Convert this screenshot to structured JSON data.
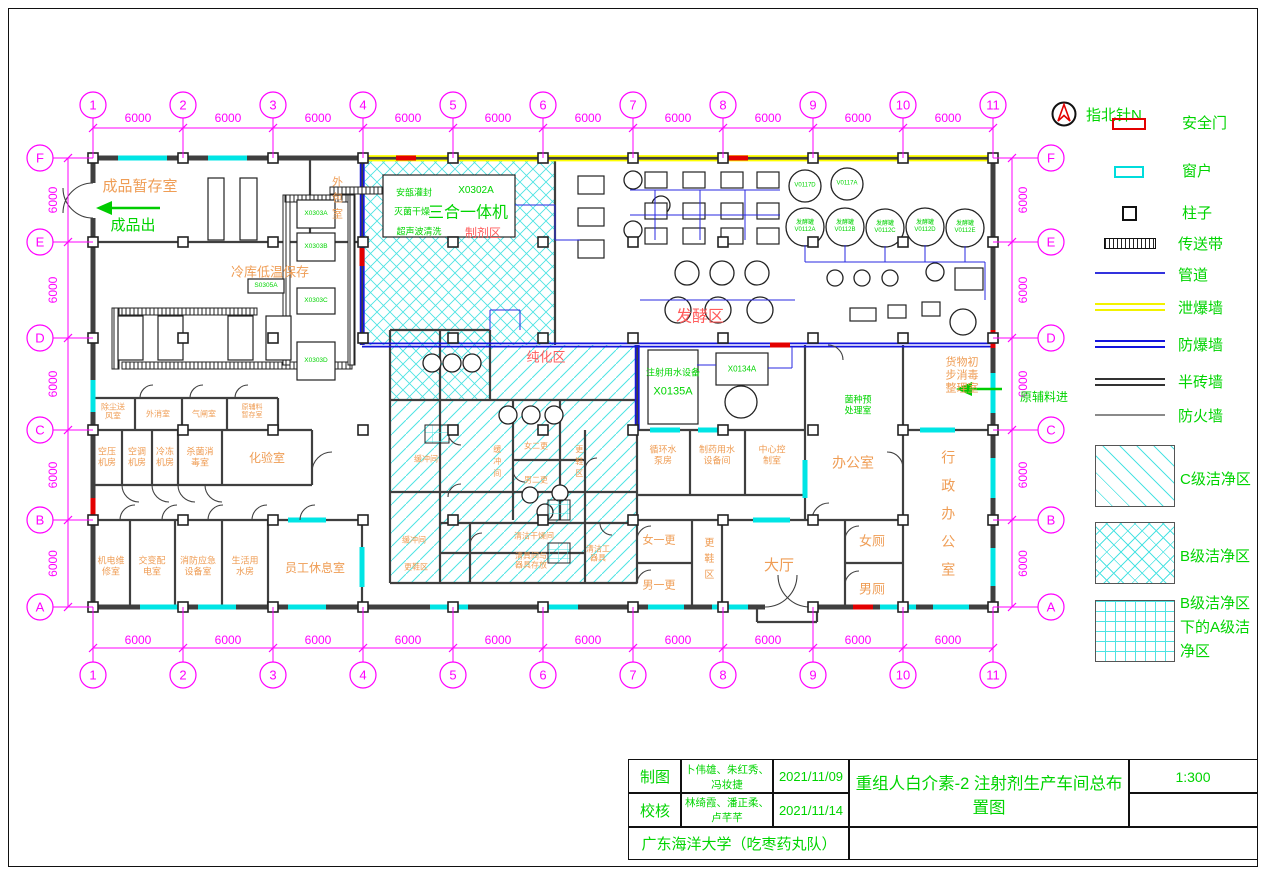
{
  "drawing": {
    "compass_label": "指北针N",
    "scale": "1:300",
    "grid": {
      "dim_label": "6000",
      "columns": [
        {
          "n": "1",
          "x": 93
        },
        {
          "n": "2",
          "x": 183
        },
        {
          "n": "3",
          "x": 273
        },
        {
          "n": "4",
          "x": 363
        },
        {
          "n": "5",
          "x": 453
        },
        {
          "n": "6",
          "x": 543
        },
        {
          "n": "7",
          "x": 633
        },
        {
          "n": "8",
          "x": 723
        },
        {
          "n": "9",
          "x": 813
        },
        {
          "n": "10",
          "x": 903
        },
        {
          "n": "11",
          "x": 993
        }
      ],
      "rows": [
        {
          "n": "F",
          "y": 158
        },
        {
          "n": "E",
          "y": 242
        },
        {
          "n": "D",
          "y": 338
        },
        {
          "n": "C",
          "y": 430
        },
        {
          "n": "B",
          "y": 520
        },
        {
          "n": "A",
          "y": 607
        }
      ]
    }
  },
  "legend": {
    "items": [
      {
        "key": "safety-door",
        "label": "安全门"
      },
      {
        "key": "window",
        "label": "窗户"
      },
      {
        "key": "column",
        "label": "柱子"
      },
      {
        "key": "conveyor",
        "label": "传送带"
      },
      {
        "key": "pipe",
        "label": "管道"
      },
      {
        "key": "vent-wall",
        "label": "泄爆墙"
      },
      {
        "key": "blast-wall",
        "label": "防爆墙"
      },
      {
        "key": "half-brick-wall",
        "label": "半砖墙"
      },
      {
        "key": "fire-wall",
        "label": "防火墙"
      }
    ],
    "zones": [
      {
        "key": "clean-c",
        "label": "C级洁净区"
      },
      {
        "key": "clean-b",
        "label": "B级洁净区"
      },
      {
        "key": "clean-a",
        "label": "B级洁净区\n下的A级洁\n净区"
      }
    ]
  },
  "titleblock": {
    "drawn_label": "制图",
    "drawn_by": "卜伟雄、朱红秀、冯妆捷",
    "drawn_date": "2021/11/09",
    "checked_label": "校核",
    "checked_by": "林绮霞、潘正柔、卢芊芊",
    "checked_date": "2021/11/14",
    "org": "广东海洋大学（吃枣药丸队）",
    "title": "重组人白介素-2 注射剂生产车间总布置图",
    "scale": "1:300"
  },
  "labels": [
    {
      "t": "成品暂存室",
      "x": 140,
      "y": 187,
      "s": 15,
      "c": "or"
    },
    {
      "t": "成品出",
      "x": 133,
      "y": 226,
      "s": 15,
      "c": "grn"
    },
    {
      "t": "外包室",
      "x": 336,
      "y": 200,
      "s": 11,
      "c": "or",
      "v": 1,
      "ls": 5
    },
    {
      "t": "冷库低温保存",
      "x": 270,
      "y": 272,
      "s": 13,
      "c": "or"
    },
    {
      "t": "除尘送\n风室",
      "x": 113,
      "y": 412,
      "s": 8,
      "c": "or"
    },
    {
      "t": "外消室",
      "x": 158,
      "y": 414,
      "s": 8,
      "c": "or"
    },
    {
      "t": "气闸室",
      "x": 204,
      "y": 414,
      "s": 8,
      "c": "or"
    },
    {
      "t": "原辅料\n暂存室",
      "x": 252,
      "y": 412,
      "s": 7,
      "c": "or"
    },
    {
      "t": "空压\n机房",
      "x": 107,
      "y": 457,
      "s": 9,
      "c": "or"
    },
    {
      "t": "空调\n机房",
      "x": 137,
      "y": 457,
      "s": 9,
      "c": "or"
    },
    {
      "t": "冷冻\n机房",
      "x": 165,
      "y": 457,
      "s": 9,
      "c": "or"
    },
    {
      "t": "杀菌消\n毒室",
      "x": 200,
      "y": 457,
      "s": 9,
      "c": "or"
    },
    {
      "t": "化验室",
      "x": 267,
      "y": 458,
      "s": 12,
      "c": "or"
    },
    {
      "t": "机电维\n修室",
      "x": 111,
      "y": 566,
      "s": 9,
      "c": "or"
    },
    {
      "t": "交变配\n电室",
      "x": 152,
      "y": 566,
      "s": 9,
      "c": "or"
    },
    {
      "t": "消防应急\n设备室",
      "x": 198,
      "y": 566,
      "s": 9,
      "c": "or"
    },
    {
      "t": "生活用\n水房",
      "x": 245,
      "y": 566,
      "s": 9,
      "c": "or"
    },
    {
      "t": "员工休息室",
      "x": 315,
      "y": 568,
      "s": 12,
      "c": "or"
    },
    {
      "t": "缓冲间",
      "x": 426,
      "y": 459,
      "s": 8,
      "c": "or"
    },
    {
      "t": "缓冲间",
      "x": 497,
      "y": 463,
      "s": 8,
      "c": "or",
      "v": 1
    },
    {
      "t": "女二更",
      "x": 536,
      "y": 446,
      "s": 8,
      "c": "or"
    },
    {
      "t": "男二更",
      "x": 536,
      "y": 480,
      "s": 8,
      "c": "or"
    },
    {
      "t": "更鞋区",
      "x": 579,
      "y": 463,
      "s": 8,
      "c": "or",
      "v": 1
    },
    {
      "t": "缓冲间",
      "x": 414,
      "y": 540,
      "s": 8,
      "c": "or"
    },
    {
      "t": "更鞋区",
      "x": 416,
      "y": 567,
      "s": 8,
      "c": "or"
    },
    {
      "t": "清洁干燥间",
      "x": 534,
      "y": 536,
      "s": 8,
      "c": "or"
    },
    {
      "t": "清具间与\n器具存放",
      "x": 531,
      "y": 561,
      "s": 8,
      "c": "or"
    },
    {
      "t": "清洁工\n器具",
      "x": 598,
      "y": 554,
      "s": 8,
      "c": "or"
    },
    {
      "t": "更鞋区",
      "x": 707,
      "y": 561,
      "s": 10,
      "c": "or",
      "v": 1,
      "ls": 6
    },
    {
      "t": "女一更",
      "x": 659,
      "y": 541,
      "s": 11,
      "c": "or"
    },
    {
      "t": "男一更",
      "x": 659,
      "y": 586,
      "s": 11,
      "c": "or"
    },
    {
      "t": "大厅",
      "x": 779,
      "y": 566,
      "s": 15,
      "c": "or"
    },
    {
      "t": "女厕",
      "x": 872,
      "y": 541,
      "s": 13,
      "c": "or"
    },
    {
      "t": "男厕",
      "x": 872,
      "y": 589,
      "s": 13,
      "c": "or"
    },
    {
      "t": "循环水\n泵房",
      "x": 663,
      "y": 455,
      "s": 9,
      "c": "or"
    },
    {
      "t": "制药用水\n设备间",
      "x": 717,
      "y": 455,
      "s": 9,
      "c": "or"
    },
    {
      "t": "中心控\n制室",
      "x": 772,
      "y": 455,
      "s": 9,
      "c": "or"
    },
    {
      "t": "办公室",
      "x": 853,
      "y": 463,
      "s": 14,
      "c": "or"
    },
    {
      "t": "行政办公室",
      "x": 948,
      "y": 520,
      "s": 14,
      "c": "or",
      "v": 1,
      "ls": 14
    },
    {
      "t": "货物初\n步消毒\n整理室",
      "x": 962,
      "y": 376,
      "s": 11,
      "c": "or"
    },
    {
      "t": "制剂区",
      "x": 483,
      "y": 233,
      "s": 12,
      "c": "pk"
    },
    {
      "t": "发酵区",
      "x": 700,
      "y": 318,
      "s": 16,
      "c": "pk"
    },
    {
      "t": "纯化区",
      "x": 546,
      "y": 357,
      "s": 13,
      "c": "pk"
    },
    {
      "t": "菌种预\n处理室",
      "x": 858,
      "y": 405,
      "s": 9,
      "c": "grn"
    },
    {
      "t": "注射用水设备",
      "x": 673,
      "y": 373,
      "s": 9,
      "c": "grn"
    },
    {
      "t": "X0135A",
      "x": 673,
      "y": 392,
      "s": 11,
      "c": "grn"
    },
    {
      "t": "X0134A",
      "x": 742,
      "y": 369,
      "s": 8,
      "c": "grn"
    },
    {
      "t": "安瓿灌封",
      "x": 414,
      "y": 193,
      "s": 9,
      "c": "grn"
    },
    {
      "t": "X0302A",
      "x": 476,
      "y": 191,
      "s": 10,
      "c": "grn"
    },
    {
      "t": "灭菌干燥",
      "x": 412,
      "y": 212,
      "s": 9,
      "c": "grn"
    },
    {
      "t": "三合一体机",
      "x": 468,
      "y": 214,
      "s": 16,
      "c": "grn"
    },
    {
      "t": "超声波清洗",
      "x": 419,
      "y": 232,
      "s": 9,
      "c": "grn"
    },
    {
      "t": "原辅料进",
      "x": 1044,
      "y": 397,
      "s": 12,
      "c": "grn"
    },
    {
      "t": "V0117D",
      "x": 805,
      "y": 186,
      "s": 6,
      "c": "grn"
    },
    {
      "t": "V0117A",
      "x": 847,
      "y": 184,
      "s": 6,
      "c": "grn"
    },
    {
      "t": "发酵罐\nV0112A",
      "x": 805,
      "y": 227,
      "s": 6,
      "c": "grn"
    },
    {
      "t": "发酵罐\nV0112B",
      "x": 845,
      "y": 227,
      "s": 6,
      "c": "grn"
    },
    {
      "t": "发酵罐\nV0112C",
      "x": 885,
      "y": 228,
      "s": 6,
      "c": "grn"
    },
    {
      "t": "发酵罐\nV0112D",
      "x": 925,
      "y": 227,
      "s": 6,
      "c": "grn"
    },
    {
      "t": "发酵罐\nV0112E",
      "x": 965,
      "y": 228,
      "s": 6,
      "c": "grn"
    },
    {
      "t": "X0303A",
      "x": 316,
      "y": 214,
      "s": 6.5,
      "c": "grn"
    },
    {
      "t": "X0303B",
      "x": 316,
      "y": 247,
      "s": 6.5,
      "c": "grn"
    },
    {
      "t": "X0303C",
      "x": 316,
      "y": 301,
      "s": 6.5,
      "c": "grn"
    },
    {
      "t": "X0303D",
      "x": 316,
      "y": 361,
      "s": 6.5,
      "c": "grn"
    },
    {
      "t": "S0305A",
      "x": 266,
      "y": 286,
      "s": 6.5,
      "c": "grn"
    }
  ],
  "equipment": {
    "circles": [
      [
        805,
        227,
        19
      ],
      [
        845,
        227,
        19
      ],
      [
        885,
        228,
        19
      ],
      [
        925,
        227,
        19
      ],
      [
        965,
        228,
        19
      ],
      [
        805,
        186,
        16
      ],
      [
        847,
        184,
        16
      ],
      [
        687,
        273,
        12
      ],
      [
        722,
        273,
        12
      ],
      [
        757,
        273,
        12
      ],
      [
        678,
        310,
        13
      ],
      [
        718,
        310,
        13
      ],
      [
        760,
        310,
        13
      ],
      [
        835,
        278,
        8
      ],
      [
        862,
        278,
        8
      ],
      [
        890,
        278,
        8
      ],
      [
        935,
        272,
        9
      ],
      [
        963,
        322,
        13
      ],
      [
        633,
        180,
        9
      ],
      [
        661,
        205,
        9
      ],
      [
        633,
        230,
        9
      ],
      [
        432,
        363,
        9
      ],
      [
        452,
        363,
        9
      ],
      [
        472,
        363,
        9
      ],
      [
        508,
        415,
        9
      ],
      [
        531,
        415,
        9
      ],
      [
        554,
        415,
        9
      ],
      [
        741,
        402,
        16
      ],
      [
        530,
        495,
        8
      ],
      [
        560,
        493,
        8
      ],
      [
        545,
        512,
        8
      ]
    ],
    "rects": [
      [
        383,
        175,
        132,
        62
      ],
      [
        208,
        178,
        16,
        62
      ],
      [
        240,
        178,
        17,
        62
      ],
      [
        648,
        350,
        50,
        74
      ],
      [
        716,
        353,
        52,
        32
      ],
      [
        297,
        200,
        38,
        28
      ],
      [
        297,
        233,
        38,
        28
      ],
      [
        297,
        288,
        38,
        26
      ],
      [
        297,
        342,
        38,
        38
      ],
      [
        118,
        316,
        25,
        44
      ],
      [
        158,
        316,
        25,
        44
      ],
      [
        228,
        316,
        25,
        44
      ],
      [
        266,
        316,
        25,
        44
      ],
      [
        248,
        279,
        36,
        14
      ],
      [
        645,
        172,
        22,
        16
      ],
      [
        645,
        203,
        22,
        16
      ],
      [
        645,
        228,
        22,
        16
      ],
      [
        683,
        172,
        22,
        16
      ],
      [
        683,
        203,
        22,
        16
      ],
      [
        683,
        228,
        22,
        16
      ],
      [
        721,
        172,
        22,
        16
      ],
      [
        721,
        203,
        22,
        16
      ],
      [
        721,
        228,
        22,
        16
      ],
      [
        757,
        172,
        22,
        16
      ],
      [
        757,
        203,
        22,
        16
      ],
      [
        757,
        228,
        22,
        16
      ],
      [
        578,
        176,
        26,
        18
      ],
      [
        578,
        208,
        26,
        18
      ],
      [
        578,
        240,
        26,
        18
      ],
      [
        955,
        268,
        28,
        22
      ],
      [
        850,
        308,
        26,
        13
      ],
      [
        888,
        305,
        18,
        13
      ],
      [
        922,
        302,
        18,
        14
      ]
    ],
    "apatches": [
      [
        425,
        425,
        24,
        18
      ],
      [
        548,
        500,
        22,
        20
      ],
      [
        548,
        543,
        22,
        20
      ]
    ],
    "conveyors": [
      [
        330,
        187,
        78,
        7
      ],
      [
        112,
        308,
        145,
        7
      ],
      [
        122,
        362,
        230,
        7
      ],
      [
        283,
        195,
        7,
        170
      ],
      [
        348,
        195,
        7,
        170
      ],
      [
        285,
        195,
        63,
        7
      ],
      [
        112,
        308,
        7,
        61
      ]
    ]
  }
}
